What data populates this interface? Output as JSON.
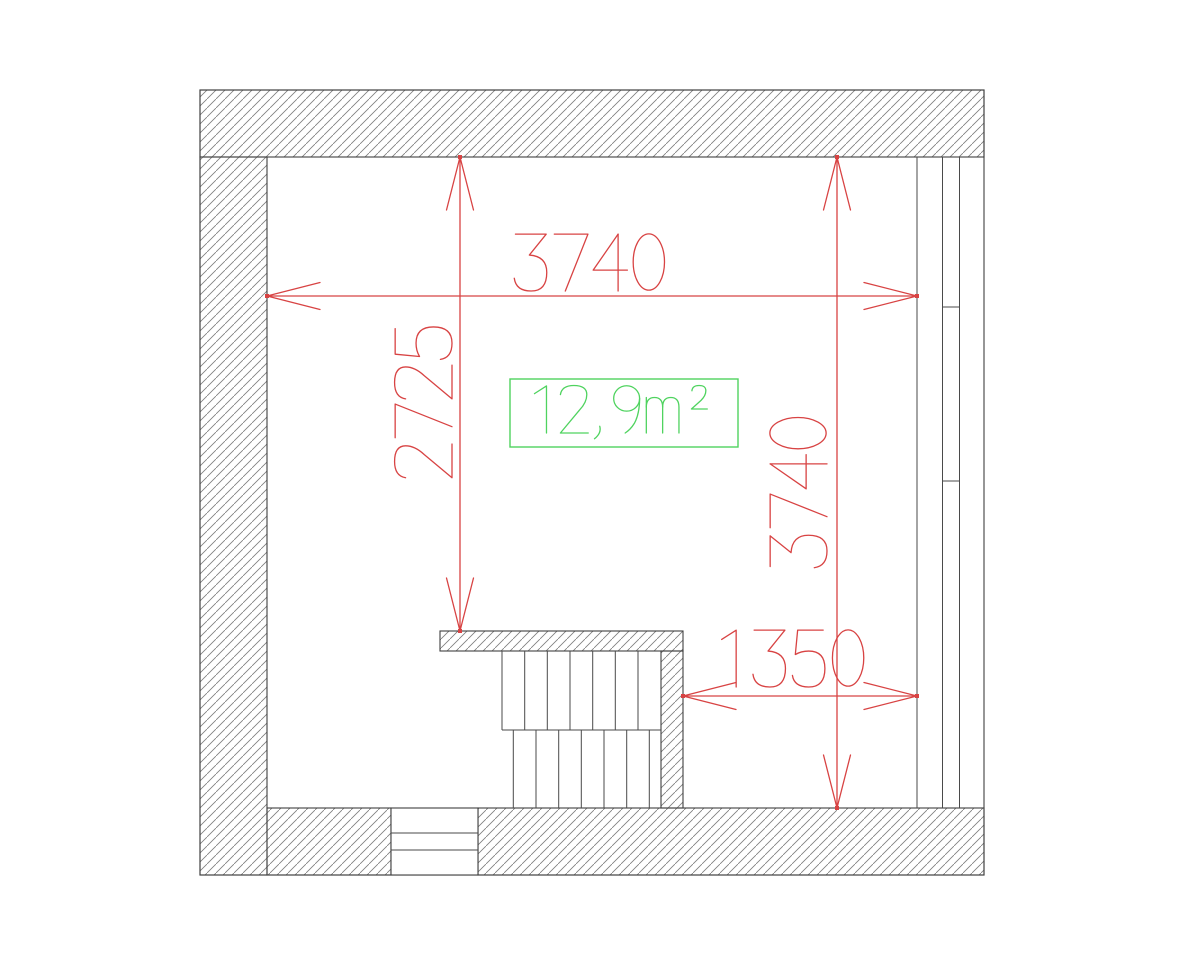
{
  "colors": {
    "dimension_red": "#d84343",
    "area_green": "#4fd35f",
    "wall_line": "#3f3f3f",
    "hatch_gray": "#7d7d7d",
    "background": "#ffffff"
  },
  "dimensions": {
    "top": {
      "value": "3740",
      "orientation": "horizontal"
    },
    "left": {
      "value": "2725",
      "orientation": "vertical"
    },
    "right": {
      "value": "3740",
      "orientation": "vertical"
    },
    "bottom_right": {
      "value": "1350",
      "orientation": "horizontal"
    }
  },
  "area_label": {
    "value": "12,9m²"
  }
}
